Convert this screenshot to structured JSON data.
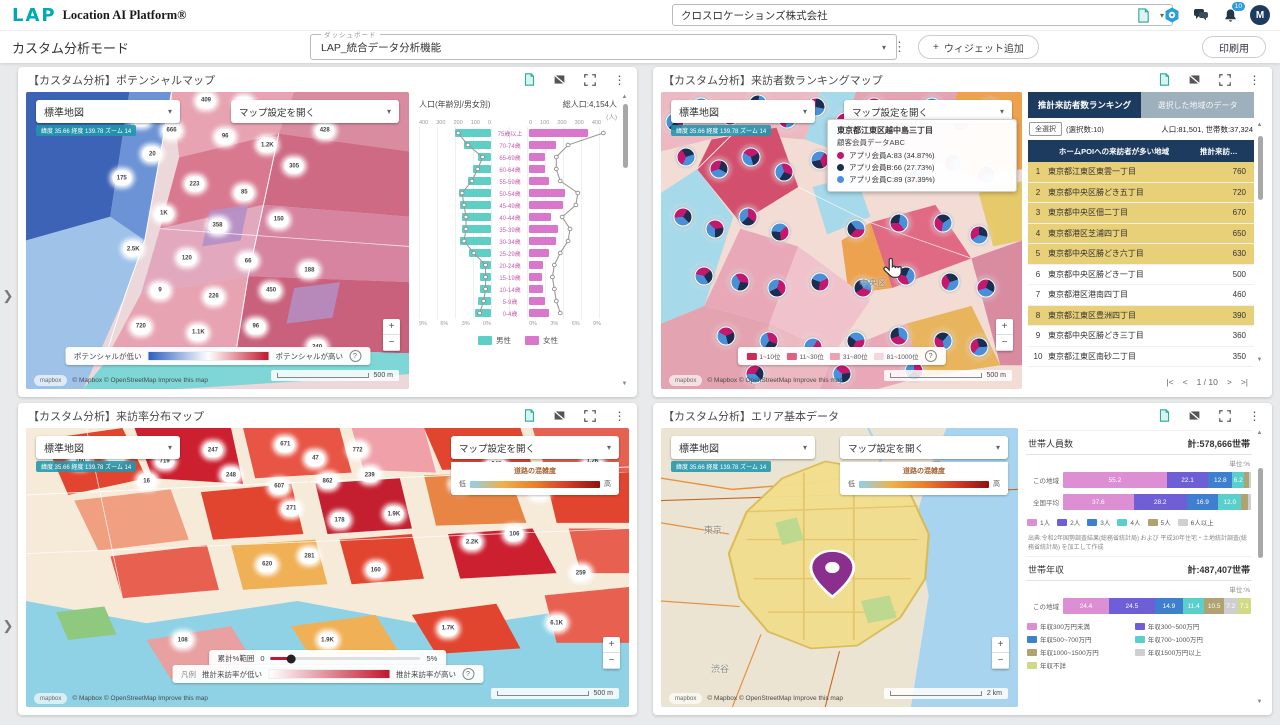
{
  "header": {
    "brand_logo": "LAP",
    "brand_name": "Location AI Platform®",
    "company": "クロスロケーションズ株式会社",
    "notification_badge": "10",
    "avatar": "M"
  },
  "toolbar": {
    "mode": "カスタム分析モード",
    "dashboard_label": "ダッシュボード",
    "dashboard_value": "LAP_統合データ分析機能",
    "add_widget": "ウィジェット追加",
    "print": "印刷用"
  },
  "icons": {
    "kebab": "⋮",
    "caret": "▾",
    "chevron_right": "❯",
    "up": "▲",
    "down": "▼",
    "plus": "+",
    "minus": "−",
    "info": "?",
    "doc": "document-export-icon",
    "gear": "settings-gear-icon",
    "chat": "chat-icon",
    "bell": "notifications-bell-icon",
    "image_off": "image-off-icon",
    "fullscreen": "fullscreen-icon"
  },
  "common": {
    "map_style": "標準地図",
    "coords": "緯度 35.66  経度 139.78  ズーム 14",
    "map_settings": "マップ設定を開く",
    "attribution": "© Mapbox © OpenStreetMap  Improve this map",
    "mapbox": "mapbox",
    "congestion_title": "道路の混雑度",
    "low": "低",
    "high": "高",
    "scale_500": "500 m",
    "scale_2km": "2 km"
  },
  "colors": {
    "congestion": [
      "#8ed0ea",
      "#f0b14a",
      "#e87f2f",
      "#d23c2a",
      "#8f1210"
    ],
    "potential_gradient": [
      "#2d5fc0",
      "#ffffff",
      "#c0182e"
    ],
    "visitrate_gradient": [
      "#ffffff",
      "#c0182e"
    ],
    "accent_navy": "#1d3b5e",
    "highlight_yellow": "#e8d078"
  },
  "potential": {
    "title": "【カスタム分析】ポテンシャルマップ",
    "legend_low": "ポテンシャルが低い",
    "legend_high": "ポテンシャルが高い"
  },
  "ranking": {
    "title": "【カスタム分析】来訪者数ランキングマップ",
    "tab_active": "推計来訪者数ランキング",
    "tab_inactive": "選択した地域のデータ",
    "select_all": "全選択",
    "selected_count": "(選択数:10)",
    "stats": "人口:81,501, 世帯数:37,324",
    "pager": {
      "first": "|<",
      "prev": "<",
      "label": "1 / 10",
      "next": ">",
      "last": ">|"
    },
    "legend": [
      {
        "label": "1~10位",
        "color": "#cc2b55"
      },
      {
        "label": "11~30位",
        "color": "#e0607f"
      },
      {
        "label": "31~80位",
        "color": "#eda2b4"
      },
      {
        "label": "81~1000位",
        "color": "#f6d6de"
      }
    ],
    "map_label": "中央区",
    "tooltip": {
      "title": "東京都江東区越中島三丁目",
      "subtitle": "顧客会員データABC",
      "items": [
        {
          "label": "アプリ会員A:83 (34.87%)",
          "color": "#c2186e"
        },
        {
          "label": "アプリ会員B:66 (27.73%)",
          "color": "#1c2d52"
        },
        {
          "label": "アプリ会員C:89 (37.39%)",
          "color": "#4a90d9"
        }
      ]
    }
  },
  "visitrate": {
    "title": "【カスタム分析】来訪率分布マップ",
    "filter_label": "累計%範囲",
    "filter_min": "0",
    "filter_max": "5%",
    "legend_prefix": "凡例",
    "legend_low": "推計来訪率が低い",
    "legend_high": "推計来訪率が高い"
  },
  "area": {
    "title": "【カスタム分析】エリア基本データ",
    "map_labels": [
      "東京",
      "渋谷"
    ],
    "unit": "単位:%",
    "source": "出典:令和2年国勢調査結果(総務省統計局) および 平成30年住宅・土地統計調査(総務省統計局) を加工して作成"
  },
  "chart_data": [
    {
      "type": "bar",
      "variant": "population-pyramid",
      "title": "人口(年齢別/男女別)",
      "total_label": "総人口:4,154人",
      "unit": "(人)",
      "categories": [
        "75歳以上",
        "70-74歳",
        "65-69歳",
        "60-64歳",
        "55-59歳",
        "50-54歳",
        "45-49歳",
        "40-44歳",
        "35-39歳",
        "30-34歳",
        "25-29歳",
        "20-24歳",
        "15-19歳",
        "10-14歳",
        "5-9歳",
        "0-4歳"
      ],
      "series": [
        {
          "name": "男性",
          "color": "#5ecfc4",
          "values": [
            200,
            150,
            75,
            100,
            130,
            180,
            170,
            160,
            160,
            170,
            120,
            60,
            60,
            60,
            70,
            90
          ]
        },
        {
          "name": "女性",
          "color": "#d977cc",
          "values": [
            330,
            150,
            90,
            90,
            110,
            200,
            190,
            120,
            160,
            150,
            110,
            80,
            70,
            80,
            90,
            110
          ]
        }
      ],
      "xlim": [
        0,
        400
      ],
      "x_ticks": [
        400,
        300,
        200,
        100,
        0
      ],
      "pct_ticks": [
        "9%",
        "6%",
        "3%",
        "0%"
      ],
      "legend_position": "bottom"
    },
    {
      "type": "table",
      "title": "推計来訪者数ランキング",
      "columns": [
        "ホームPOIへの来訪者が多い地域",
        "推計来訪…"
      ],
      "rows": [
        {
          "rank": 1,
          "area": "東京都江東区東雲一丁目",
          "value": 760,
          "selected": true
        },
        {
          "rank": 2,
          "area": "東京都中央区勝どき五丁目",
          "value": 720,
          "selected": true
        },
        {
          "rank": 3,
          "area": "東京都中央区佃二丁目",
          "value": 670,
          "selected": true
        },
        {
          "rank": 4,
          "area": "東京都港区芝浦四丁目",
          "value": 650,
          "selected": true
        },
        {
          "rank": 5,
          "area": "東京都中央区勝どき六丁目",
          "value": 630,
          "selected": true
        },
        {
          "rank": 6,
          "area": "東京都中央区勝どき一丁目",
          "value": 500,
          "selected": false
        },
        {
          "rank": 7,
          "area": "東京都港区港南四丁目",
          "value": 460,
          "selected": false
        },
        {
          "rank": 8,
          "area": "東京都江東区豊洲四丁目",
          "value": 390,
          "selected": true
        },
        {
          "rank": 9,
          "area": "東京都中央区勝どき三丁目",
          "value": 360,
          "selected": false
        },
        {
          "rank": 10,
          "area": "東京都江東区南砂二丁目",
          "value": 350,
          "selected": false
        }
      ]
    },
    {
      "type": "bar",
      "variant": "stacked-horizontal",
      "title": "世帯人員数",
      "total_label": "計:578,666世帯",
      "unit": "%",
      "categories": [
        "1人",
        "2人",
        "3人",
        "4人",
        "5人",
        "6人以上"
      ],
      "colors": [
        "#dd8fd3",
        "#6f5fd6",
        "#3f7fd0",
        "#5bd0cb",
        "#b0a271",
        "#cfcfcf"
      ],
      "series": [
        {
          "name": "この地域",
          "values": [
            55.2,
            22.1,
            12.8,
            6.2,
            2.5,
            1.2
          ]
        },
        {
          "name": "全国平均",
          "values": [
            37.6,
            28.2,
            16.9,
            12.0,
            3.6,
            1.7
          ]
        }
      ]
    },
    {
      "type": "bar",
      "variant": "stacked-horizontal",
      "title": "世帯年収",
      "total_label": "計:487,407世帯",
      "unit": "%",
      "categories": [
        "年収300万円未満",
        "年収300~500万円",
        "年収500~700万円",
        "年収700~1000万円",
        "年収1000~1500万円",
        "年収1500万円以上",
        "年収不詳"
      ],
      "colors": [
        "#dd8fd3",
        "#6f5fd6",
        "#3f7fd0",
        "#5bd0cb",
        "#b0a271",
        "#cfcfcf",
        "#d3da85"
      ],
      "series": [
        {
          "name": "この地域",
          "values": [
            24.4,
            24.5,
            14.9,
            11.4,
            10.5,
            7.2,
            7.1
          ]
        }
      ]
    }
  ],
  "maps": {
    "pie_colors": [
      "#c2186e",
      "#1c2d52",
      "#4a90d9"
    ],
    "pie_fracs": [
      35,
      28,
      37
    ],
    "potential_bubbles": [
      [
        47,
        3,
        "409"
      ],
      [
        57,
        4,
        "5.2K"
      ],
      [
        30,
        9,
        "48"
      ],
      [
        38,
        13,
        "666"
      ],
      [
        33,
        21,
        "20"
      ],
      [
        78,
        13,
        "428"
      ],
      [
        52,
        15,
        "96"
      ],
      [
        63,
        18,
        "1.2K"
      ],
      [
        70,
        25,
        "305"
      ],
      [
        25,
        29,
        "175"
      ],
      [
        44,
        31,
        "223"
      ],
      [
        57,
        34,
        "85"
      ],
      [
        36,
        41,
        "1K"
      ],
      [
        50,
        45,
        "358"
      ],
      [
        66,
        43,
        "150"
      ],
      [
        28,
        53,
        "2.5K"
      ],
      [
        42,
        56,
        "120"
      ],
      [
        58,
        57,
        "66"
      ],
      [
        35,
        67,
        "9"
      ],
      [
        49,
        69,
        "226"
      ],
      [
        64,
        67,
        "450"
      ],
      [
        30,
        79,
        "720"
      ],
      [
        45,
        81,
        "1.1K"
      ],
      [
        60,
        79,
        "96"
      ],
      [
        74,
        60,
        "188"
      ],
      [
        76,
        86,
        "240"
      ]
    ],
    "visitrate_bubbles": [
      [
        9,
        12,
        "160"
      ],
      [
        15,
        10,
        "190"
      ],
      [
        23,
        12,
        "719"
      ],
      [
        31,
        8,
        "247"
      ],
      [
        43,
        6,
        "671"
      ],
      [
        48,
        11,
        "47"
      ],
      [
        55,
        8,
        "772"
      ],
      [
        20,
        19,
        "16"
      ],
      [
        34,
        17,
        "248"
      ],
      [
        42,
        21,
        "607"
      ],
      [
        50,
        19,
        "862"
      ],
      [
        57,
        17,
        "239"
      ],
      [
        44,
        29,
        "271"
      ],
      [
        52,
        33,
        "178"
      ],
      [
        61,
        31,
        "1.9K"
      ],
      [
        72,
        20,
        "1K"
      ],
      [
        78,
        13,
        "948"
      ],
      [
        85,
        23,
        "239"
      ],
      [
        74,
        41,
        "2.2K"
      ],
      [
        81,
        38,
        "106"
      ],
      [
        40,
        49,
        "620"
      ],
      [
        47,
        46,
        "281"
      ],
      [
        58,
        51,
        "160"
      ],
      [
        26,
        76,
        "108"
      ],
      [
        50,
        76,
        "1.9K"
      ],
      [
        70,
        72,
        "1.7K"
      ],
      [
        88,
        70,
        "6.1K"
      ],
      [
        92,
        52,
        "259"
      ],
      [
        94,
        12,
        "1.2K"
      ]
    ],
    "ranking_pies": [
      [
        4,
        10
      ],
      [
        11,
        5
      ],
      [
        19,
        8
      ],
      [
        27,
        4
      ],
      [
        35,
        9
      ],
      [
        43,
        5
      ],
      [
        51,
        10
      ],
      [
        59,
        5
      ],
      [
        67,
        9
      ],
      [
        75,
        5
      ],
      [
        83,
        10
      ],
      [
        91,
        6
      ],
      [
        7,
        22
      ],
      [
        16,
        26
      ],
      [
        25,
        22
      ],
      [
        34,
        27
      ],
      [
        44,
        23
      ],
      [
        62,
        24
      ],
      [
        71,
        28
      ],
      [
        81,
        24
      ],
      [
        90,
        28
      ],
      [
        6,
        42
      ],
      [
        15,
        46
      ],
      [
        24,
        42
      ],
      [
        33,
        47
      ],
      [
        54,
        46
      ],
      [
        66,
        44
      ],
      [
        78,
        44
      ],
      [
        88,
        48
      ],
      [
        12,
        62
      ],
      [
        22,
        64
      ],
      [
        32,
        66
      ],
      [
        44,
        64
      ],
      [
        56,
        66
      ],
      [
        68,
        62
      ],
      [
        80,
        64
      ],
      [
        90,
        66
      ],
      [
        18,
        82
      ],
      [
        30,
        84
      ],
      [
        42,
        86
      ],
      [
        54,
        84
      ],
      [
        66,
        82
      ],
      [
        78,
        84
      ],
      [
        88,
        86
      ],
      [
        26,
        95
      ],
      [
        50,
        95
      ],
      [
        70,
        94
      ]
    ]
  }
}
